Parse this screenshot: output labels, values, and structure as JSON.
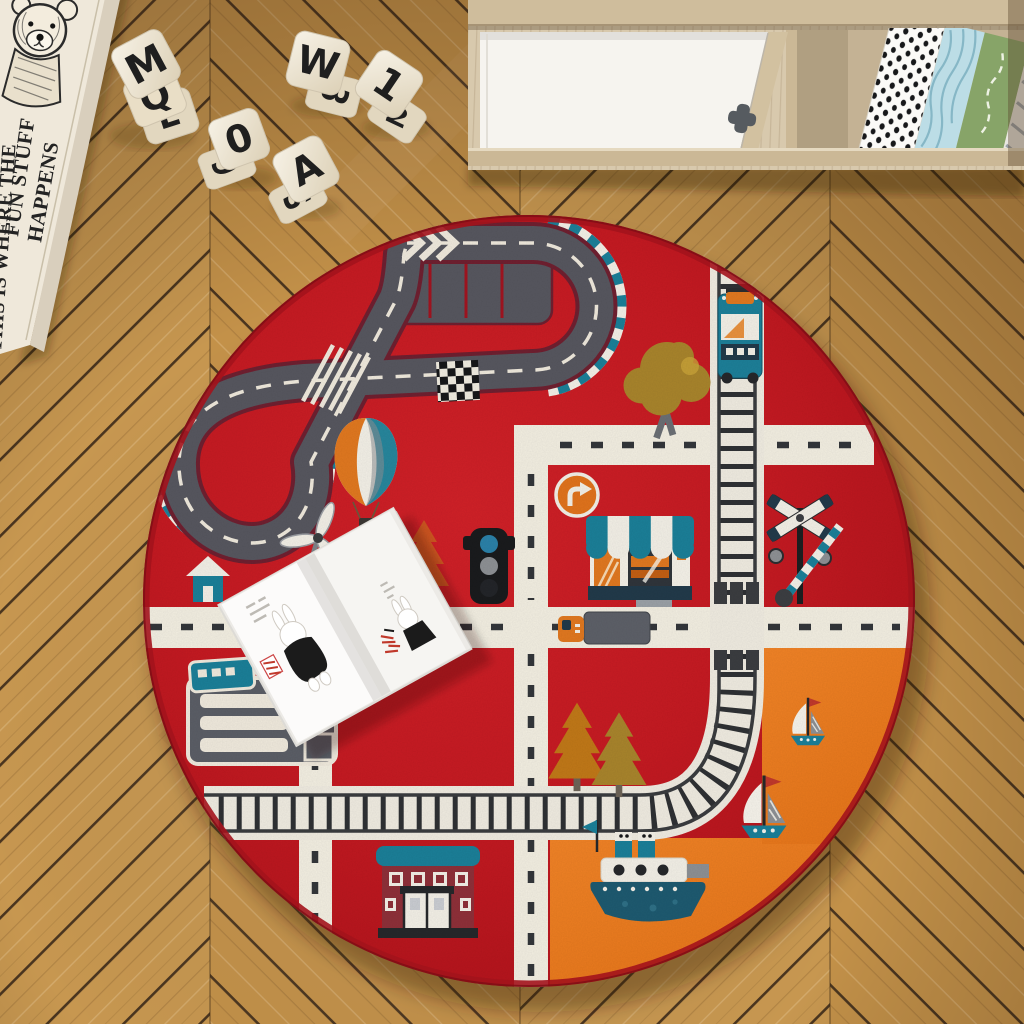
{
  "scene": {
    "description": "Top-down photo of a kids playroom: round red city-road play rug on herringbone oak floor, wooden letter blocks, storage crate with sketched bear and quote, white cabinet with shelf books, open picture book lying on the rug",
    "floor": "herringbone oak planks"
  },
  "crate": {
    "lines": [
      "THIS IS WHERE THE",
      "FUN STUFF",
      "HAPPENS"
    ],
    "art": "sketched teddy bear"
  },
  "blocks": [
    {
      "faces": [
        "M",
        "Q"
      ]
    },
    {
      "faces": [
        "E"
      ]
    },
    {
      "faces": [
        "0",
        "6"
      ]
    },
    {
      "faces": [
        "A",
        "S"
      ]
    },
    {
      "faces": [
        "W",
        "3"
      ]
    },
    {
      "faces": [
        "1",
        "2"
      ]
    }
  ],
  "cabinet": {
    "knob": "cross-shaped grey knob",
    "books": [
      "black polka dot",
      "blue wave stripes",
      "green with white script",
      "grey diagonal stripes",
      "cream"
    ]
  },
  "rug": {
    "shape": "round",
    "theme": "city roads and race track",
    "motifs": [
      "race track with teal checkered curbs",
      "pit lane with chevrons and red bays",
      "checkered finish line",
      "hot air balloon",
      "train on railway",
      "railway track with level crossing",
      "cream roads with dashed centerlines",
      "traffic light",
      "turn-right sign",
      "shop with striped awning",
      "school house",
      "bus depot",
      "truck",
      "windmill",
      "small house",
      "pine trees",
      "round trees",
      "steamboat",
      "two sailboats",
      "orange harbor quarter"
    ]
  },
  "book": {
    "state": "open on rug",
    "content": "bunny character illustrations"
  },
  "colors": {
    "rug_red": "#c41a22",
    "rug_orange": "#ed7a1e",
    "track_grey": "#57575f",
    "road_cream": "#f2eee1",
    "teal": "#1b7f98",
    "navy": "#223a4a",
    "wood_floor": "#c79750",
    "cabinet_wood": "#d8c9ad",
    "cabinet_door": "#f6f4ef",
    "crate_wood": "#efe8da",
    "maroon_house": "#8e3039",
    "sign_orange": "#e0731c"
  }
}
